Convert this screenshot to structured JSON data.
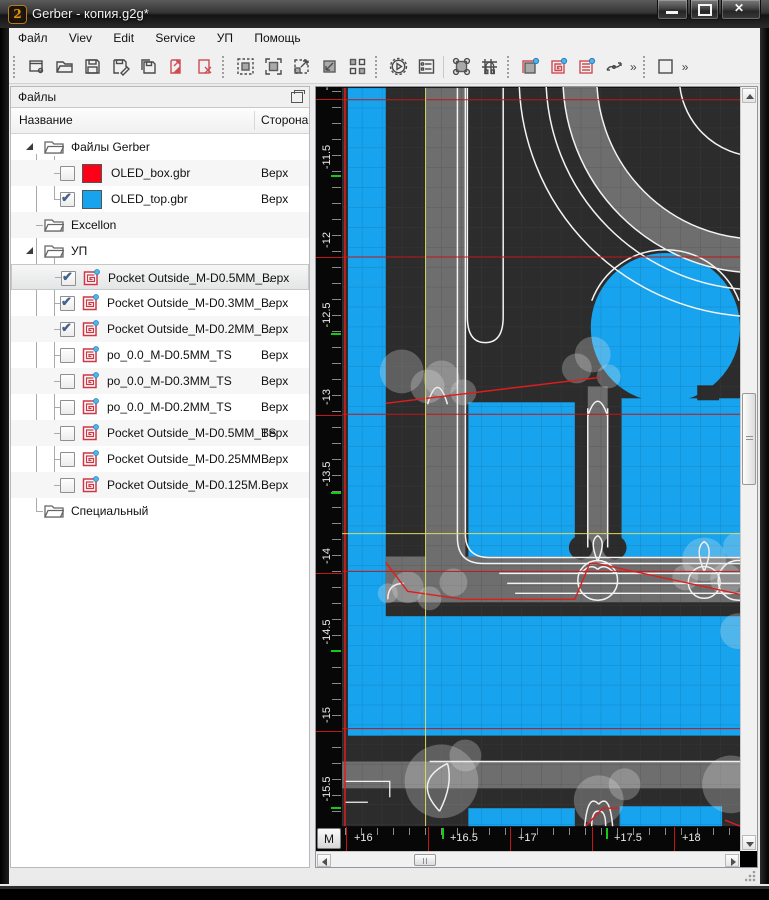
{
  "window": {
    "title": "Gerber - копия.g2g*",
    "controls": [
      "minimize",
      "maximize",
      "close"
    ]
  },
  "glyphs": {
    "close": "✕",
    "check": "✔",
    "chevron": "»"
  },
  "menu": {
    "items": [
      "Файл",
      "Viev",
      "Edit",
      "Service",
      "УП",
      "Помощь"
    ]
  },
  "toolbar": {
    "overflow_label": "»",
    "buttons": [
      "new-project",
      "open",
      "save",
      "save-as",
      "save-copy",
      "import-file",
      "close-file",
      "zoom-extents",
      "zoom-window",
      "zoom-out",
      "zoom-in",
      "tile-windows",
      "postprocess",
      "project-settings",
      "edit-nodes",
      "snap-magnet",
      "pocket-outside",
      "pocket-spiral",
      "pocket-raster",
      "smooth-curve",
      "shape-rect"
    ]
  },
  "files_panel": {
    "title": "Файлы",
    "columns": {
      "name": "Название",
      "side": "Сторона"
    },
    "tree": [
      {
        "type": "folder",
        "label": "Файлы Gerber",
        "expanded": true
      },
      {
        "type": "layer",
        "label": "OLED_box.gbr",
        "side": "Верх",
        "checked": false,
        "swatch": "#fb0017"
      },
      {
        "type": "layer",
        "label": "OLED_top.gbr",
        "side": "Верх",
        "checked": true,
        "swatch": "#17a3ed"
      },
      {
        "type": "folder",
        "label": "Excellon",
        "expanded": false
      },
      {
        "type": "folder",
        "label": "УП",
        "expanded": true
      },
      {
        "type": "job",
        "label": "Pocket Outside_M-D0.5MM_...",
        "side": "Верх",
        "checked": true,
        "selected": true
      },
      {
        "type": "job",
        "label": "Pocket Outside_M-D0.3MM_...",
        "side": "Верх",
        "checked": true
      },
      {
        "type": "job",
        "label": "Pocket Outside_M-D0.2MM_...",
        "side": "Верх",
        "checked": true
      },
      {
        "type": "job",
        "label": "po_0.0_M-D0.5MM_TS",
        "side": "Верх",
        "checked": false
      },
      {
        "type": "job",
        "label": "po_0.0_M-D0.3MM_TS",
        "side": "Верх",
        "checked": false
      },
      {
        "type": "job",
        "label": "po_0.0_M-D0.2MM_TS",
        "side": "Верх",
        "checked": false
      },
      {
        "type": "job",
        "label": "Pocket Outside_M-D0.5MM_TS",
        "side": "Верх",
        "checked": false
      },
      {
        "type": "job",
        "label": "Pocket Outside_M-D0.25MM...",
        "side": "Верх",
        "checked": false
      },
      {
        "type": "job",
        "label": "Pocket Outside_M-D0.125M...",
        "side": "Верх",
        "checked": false
      },
      {
        "type": "folder",
        "label": "Специальный",
        "expanded": false
      }
    ]
  },
  "viewport": {
    "rulers": {
      "unit_button": "M",
      "vertical_labels": [
        "-11",
        "-11.5",
        "-12",
        "-12.5",
        "-13",
        "-13.5",
        "-14",
        "-14.5",
        "-15",
        "-15.5"
      ],
      "horizontal_labels": [
        "+16",
        "+16.5",
        "+17",
        "+17.5",
        "+18"
      ]
    },
    "colors": {
      "background": "#2c2c2c",
      "copper": "#17a3ed",
      "milled": "#6e6e6e",
      "contour": "#f3f3f3",
      "rapid_move": "#e01d1d",
      "grid_major_red": "#bf1717",
      "zero_cross_yellow": "#d9d964",
      "ruler_green_tick": "#17c917"
    }
  }
}
